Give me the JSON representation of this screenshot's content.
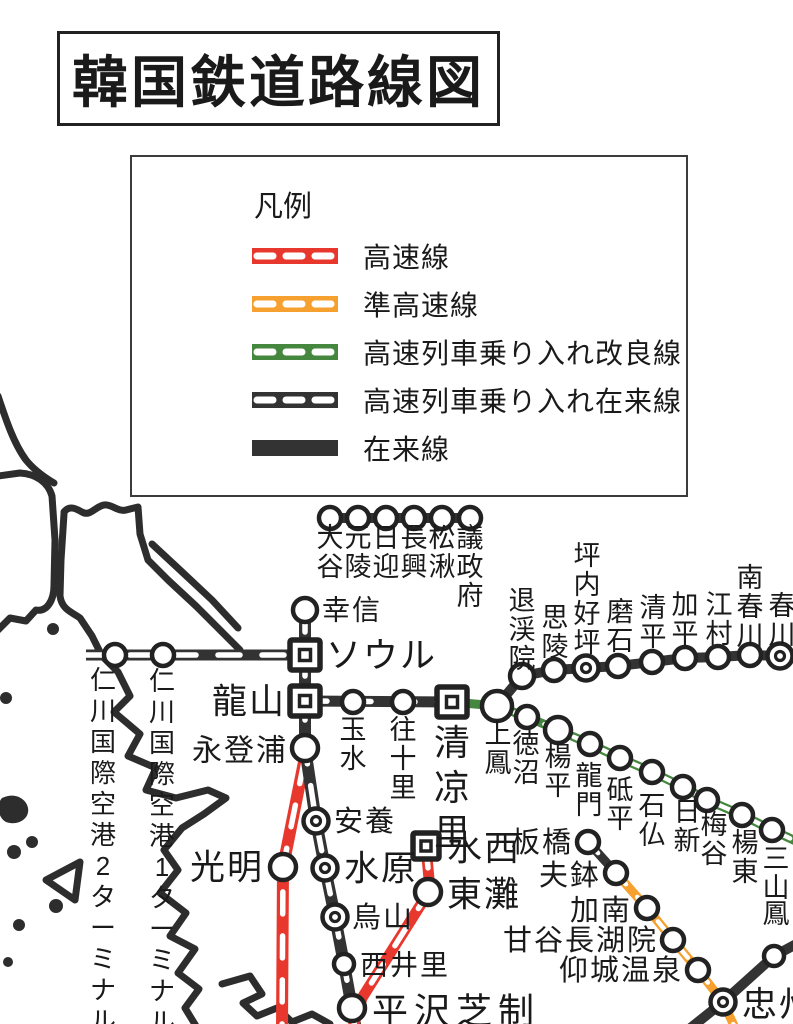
{
  "title": "韓国鉄道路線図",
  "legend": {
    "heading": "凡例",
    "items": [
      {
        "label": "高速線",
        "style": "hsr"
      },
      {
        "label": "準高速線",
        "style": "semi_hsr"
      },
      {
        "label": "高速列車乗り入れ改良線",
        "style": "hst_improved"
      },
      {
        "label": "高速列車乗り入れ在来線",
        "style": "hst_conventional"
      },
      {
        "label": "在来線",
        "style": "conventional"
      }
    ]
  },
  "line_styles": {
    "hsr": {
      "color": "#E8382D",
      "dashed": true
    },
    "semi_hsr": {
      "color": "#F6A12F",
      "dashed": true
    },
    "hst_improved": {
      "color": "#45873E",
      "dashed": true
    },
    "hst_conventional": {
      "color": "#333333",
      "dashed": true
    },
    "conventional": {
      "color": "#333333",
      "dashed": false
    }
  },
  "map": {
    "lines": [
      {
        "name": "gyowoe",
        "style": "conventional",
        "w": 10,
        "pts": [
          [
            330,
            518
          ],
          [
            470,
            518
          ]
        ]
      },
      {
        "name": "arex",
        "style": "hst_conventional",
        "w": 11,
        "pts": [
          [
            86,
            655
          ],
          [
            305,
            655
          ]
        ]
      },
      {
        "name": "gyeongbu-hsr",
        "style": "hsr",
        "w": 12,
        "pts": [
          [
            304,
            762
          ],
          [
            283,
            867
          ],
          [
            282,
            1030
          ]
        ]
      },
      {
        "name": "gyeongbu-trunk",
        "style": "hst_conventional",
        "w": 12,
        "pts": [
          [
            305,
            610
          ],
          [
            305,
            748
          ],
          [
            316,
            821
          ],
          [
            325,
            868
          ],
          [
            335,
            917
          ],
          [
            344,
            964
          ],
          [
            352,
            1008
          ],
          [
            356,
            1030
          ]
        ]
      },
      {
        "name": "yongsan-cheongnyangni",
        "style": "hst_conventional",
        "w": 11,
        "pts": [
          [
            305,
            701
          ],
          [
            452,
            702
          ]
        ]
      },
      {
        "name": "jungang",
        "style": "hst_improved",
        "w": 9,
        "pts": [
          [
            452,
            702
          ],
          [
            497,
            706
          ],
          [
            527,
            717
          ],
          [
            558,
            730
          ],
          [
            590,
            744
          ],
          [
            620,
            758
          ],
          [
            652,
            772
          ],
          [
            683,
            787
          ],
          [
            707,
            800
          ],
          [
            742,
            815
          ],
          [
            772,
            830
          ],
          [
            800,
            843
          ]
        ]
      },
      {
        "name": "gyeongchun",
        "style": "conventional",
        "w": 10,
        "pts": [
          [
            497,
            706
          ],
          [
            522,
            676
          ],
          [
            554,
            670
          ],
          [
            586,
            668
          ],
          [
            618,
            666
          ],
          [
            652,
            662
          ],
          [
            685,
            658
          ],
          [
            718,
            657
          ],
          [
            750,
            655
          ],
          [
            780,
            656
          ]
        ]
      },
      {
        "name": "suseo-hsr",
        "style": "hsr",
        "w": 11,
        "pts": [
          [
            426,
            846
          ],
          [
            430,
            890
          ],
          [
            362,
            998
          ],
          [
            352,
            1030
          ]
        ]
      },
      {
        "name": "gyeonggang",
        "style": "hst_conventional",
        "w": 9,
        "pts": [
          [
            588,
            842
          ],
          [
            616,
            873
          ]
        ]
      },
      {
        "name": "chungbuk",
        "style": "conventional",
        "w": 10,
        "pts": [
          [
            688,
            1030
          ],
          [
            723,
            1002
          ],
          [
            774,
            956
          ],
          [
            800,
            942
          ]
        ]
      },
      {
        "name": "jungbunaeryuk",
        "style": "semi_hsr",
        "w": 9,
        "pts": [
          [
            616,
            873
          ],
          [
            647,
            908
          ],
          [
            673,
            940
          ],
          [
            698,
            970
          ],
          [
            723,
            1002
          ],
          [
            736,
            1030
          ]
        ]
      }
    ],
    "stations": [
      {
        "label": "大谷",
        "x": 330,
        "y": 518,
        "marker": "circle",
        "o": "v",
        "lx": 330,
        "ly": 538,
        "fs": 27
      },
      {
        "label": "元陵",
        "x": 358,
        "y": 518,
        "marker": "circle",
        "o": "v",
        "lx": 358,
        "ly": 538,
        "fs": 27
      },
      {
        "label": "日迎",
        "x": 386,
        "y": 518,
        "marker": "circle",
        "o": "v",
        "lx": 386,
        "ly": 538,
        "fs": 27
      },
      {
        "label": "長興",
        "x": 414,
        "y": 518,
        "marker": "circle",
        "o": "v",
        "lx": 414,
        "ly": 538,
        "fs": 27
      },
      {
        "label": "松湫",
        "x": 442,
        "y": 518,
        "marker": "circle",
        "o": "v",
        "lx": 442,
        "ly": 538,
        "fs": 27
      },
      {
        "label": "議政府",
        "x": 470,
        "y": 518,
        "marker": "circle",
        "o": "v",
        "lx": 470,
        "ly": 538,
        "fs": 27
      },
      {
        "label": "仁川国際空港2ターミナル",
        "x": 115,
        "y": 655,
        "marker": "circle",
        "o": "v",
        "lx": 103,
        "ly": 680,
        "fs": 26,
        "step": 31
      },
      {
        "label": "仁川国際空港1ターミナル",
        "x": 163,
        "y": 655,
        "marker": "circle",
        "o": "v",
        "lx": 162,
        "ly": 681,
        "fs": 26,
        "step": 31
      },
      {
        "label": "幸信",
        "x": 305,
        "y": 610,
        "marker": "circle",
        "r": 12,
        "o": "h",
        "lx": 322,
        "ly": 610,
        "fs": 28
      },
      {
        "label": "ソウル",
        "x": 305,
        "y": 655,
        "marker": "square",
        "size": 30,
        "o": "h",
        "lx": 326,
        "ly": 656,
        "fs": 35
      },
      {
        "label": "龍山",
        "x": 305,
        "y": 701,
        "marker": "square",
        "size": 30,
        "o": "h",
        "anchor": "end",
        "lx": 286,
        "ly": 702,
        "fs": 35
      },
      {
        "label": "永登浦",
        "x": 305,
        "y": 748,
        "marker": "circle",
        "r": 13,
        "o": "h",
        "anchor": "end",
        "lx": 288,
        "ly": 751,
        "fs": 30
      },
      {
        "label": "安養",
        "x": 316,
        "y": 821,
        "marker": "double",
        "o": "h",
        "lx": 334,
        "ly": 822,
        "fs": 29
      },
      {
        "label": "水原",
        "x": 325,
        "y": 868,
        "marker": "double",
        "o": "h",
        "lx": 344,
        "ly": 869,
        "fs": 35
      },
      {
        "label": "烏山",
        "x": 335,
        "y": 917,
        "marker": "double",
        "o": "h",
        "lx": 352,
        "ly": 918,
        "fs": 29
      },
      {
        "label": "西井里",
        "x": 344,
        "y": 964,
        "marker": "circle",
        "r": 10,
        "o": "h",
        "lx": 360,
        "ly": 965,
        "fs": 28
      },
      {
        "label": "平沢芝制",
        "x": 352,
        "y": 1008,
        "marker": "circle",
        "r": 13,
        "o": "h",
        "lx": 372,
        "ly": 1011,
        "fs": 36,
        "ls": 6
      },
      {
        "label": "光明",
        "x": 283,
        "y": 867,
        "marker": "circle",
        "r": 13,
        "o": "h",
        "anchor": "end",
        "lx": 264,
        "ly": 868,
        "fs": 35
      },
      {
        "label": "玉水",
        "x": 353,
        "y": 702,
        "marker": "circle",
        "o": "v",
        "lx": 353,
        "ly": 730,
        "fs": 27
      },
      {
        "label": "往十里",
        "x": 403,
        "y": 702,
        "marker": "circle",
        "o": "v",
        "lx": 403,
        "ly": 730,
        "fs": 27
      },
      {
        "label": "清凉里",
        "x": 452,
        "y": 702,
        "marker": "square",
        "size": 30,
        "o": "v",
        "lx": 452,
        "ly": 742,
        "fs": 36,
        "step": 45
      },
      {
        "label": "上鳳",
        "x": 497,
        "y": 706,
        "marker": "circle",
        "r": 15,
        "o": "v",
        "lx": 498,
        "ly": 734,
        "fs": 27
      },
      {
        "label": "徳沼",
        "x": 527,
        "y": 717,
        "marker": "circle",
        "o": "v",
        "lx": 526,
        "ly": 744,
        "fs": 27
      },
      {
        "label": "楊平",
        "x": 558,
        "y": 730,
        "marker": "circle",
        "r": 13,
        "o": "v",
        "lx": 558,
        "ly": 757,
        "fs": 27
      },
      {
        "label": "龍門",
        "x": 590,
        "y": 744,
        "marker": "circle",
        "o": "v",
        "lx": 589,
        "ly": 776,
        "fs": 27
      },
      {
        "label": "砥平",
        "x": 620,
        "y": 758,
        "marker": "circle",
        "o": "v",
        "lx": 620,
        "ly": 790,
        "fs": 27
      },
      {
        "label": "石仏",
        "x": 652,
        "y": 772,
        "marker": "circle",
        "o": "v",
        "lx": 652,
        "ly": 806,
        "fs": 27
      },
      {
        "label": "日新",
        "x": 683,
        "y": 787,
        "marker": "circle",
        "o": "v",
        "lx": 687,
        "ly": 812,
        "fs": 27
      },
      {
        "label": "梅谷",
        "x": 707,
        "y": 800,
        "marker": "circle",
        "o": "v",
        "lx": 714,
        "ly": 825,
        "fs": 27
      },
      {
        "label": "楊東",
        "x": 742,
        "y": 815,
        "marker": "circle",
        "o": "v",
        "lx": 745,
        "ly": 843,
        "fs": 27
      },
      {
        "label": "三山",
        "x": 772,
        "y": 830,
        "marker": "circle",
        "o": "v",
        "lx": 776,
        "ly": 859,
        "fs": 27
      },
      {
        "label": "鳳",
        "x": 774,
        "y": 956,
        "marker": "circle",
        "r": 10,
        "o": "v",
        "lx": 776,
        "ly": 914,
        "fs": 27
      },
      {
        "label": "退渓院",
        "x": 522,
        "y": 676,
        "marker": "circle",
        "r": 12,
        "o": "v",
        "lx": 522,
        "ly": 601,
        "fs": 27
      },
      {
        "label": "思陵",
        "x": 554,
        "y": 670,
        "marker": "circle",
        "o": "v",
        "lx": 555,
        "ly": 618,
        "fs": 27
      },
      {
        "label": "坪内好坪",
        "x": 586,
        "y": 668,
        "marker": "double",
        "o": "v",
        "lx": 587,
        "ly": 556,
        "fs": 27
      },
      {
        "label": "磨石",
        "x": 618,
        "y": 666,
        "marker": "circle",
        "o": "v",
        "lx": 620,
        "ly": 612,
        "fs": 27
      },
      {
        "label": "清平",
        "x": 652,
        "y": 662,
        "marker": "circle",
        "o": "v",
        "lx": 653,
        "ly": 608,
        "fs": 27
      },
      {
        "label": "加平",
        "x": 685,
        "y": 658,
        "marker": "circle",
        "o": "v",
        "lx": 685,
        "ly": 605,
        "fs": 27
      },
      {
        "label": "江村",
        "x": 718,
        "y": 657,
        "marker": "circle",
        "o": "v",
        "lx": 719,
        "ly": 605,
        "fs": 27
      },
      {
        "label": "南春川",
        "x": 750,
        "y": 655,
        "marker": "circle",
        "o": "v",
        "lx": 750,
        "ly": 578,
        "fs": 27
      },
      {
        "label": "春川",
        "x": 780,
        "y": 656,
        "marker": "double",
        "o": "v",
        "lx": 782,
        "ly": 606,
        "fs": 27
      },
      {
        "label": "板橋",
        "x": 588,
        "y": 842,
        "marker": "circle",
        "o": "h",
        "anchor": "end",
        "lx": 573,
        "ly": 843,
        "fs": 29
      },
      {
        "label": "夫鉢",
        "x": 616,
        "y": 873,
        "marker": "circle",
        "o": "h",
        "anchor": "end",
        "lx": 601,
        "ly": 876,
        "fs": 29
      },
      {
        "label": "加南",
        "x": 647,
        "y": 908,
        "marker": "circle",
        "o": "h",
        "anchor": "end",
        "lx": 632,
        "ly": 911,
        "fs": 29
      },
      {
        "label": "甘谷長湖院",
        "x": 673,
        "y": 940,
        "marker": "circle",
        "o": "h",
        "anchor": "end",
        "lx": 658,
        "ly": 941,
        "fs": 29
      },
      {
        "label": "仰城温泉",
        "x": 698,
        "y": 970,
        "marker": "circle",
        "o": "h",
        "anchor": "end",
        "lx": 683,
        "ly": 971,
        "fs": 29
      },
      {
        "label": "忠州",
        "x": 723,
        "y": 1002,
        "marker": "double",
        "o": "h",
        "lx": 742,
        "ly": 1005,
        "fs": 35
      },
      {
        "label": "水西",
        "x": 426,
        "y": 846,
        "marker": "square",
        "size": 26,
        "o": "h",
        "lx": 447,
        "ly": 849,
        "fs": 35
      },
      {
        "label": "東灘",
        "x": 428,
        "y": 892,
        "marker": "circle",
        "r": 13,
        "o": "h",
        "lx": 447,
        "ly": 895,
        "fs": 35
      }
    ]
  }
}
